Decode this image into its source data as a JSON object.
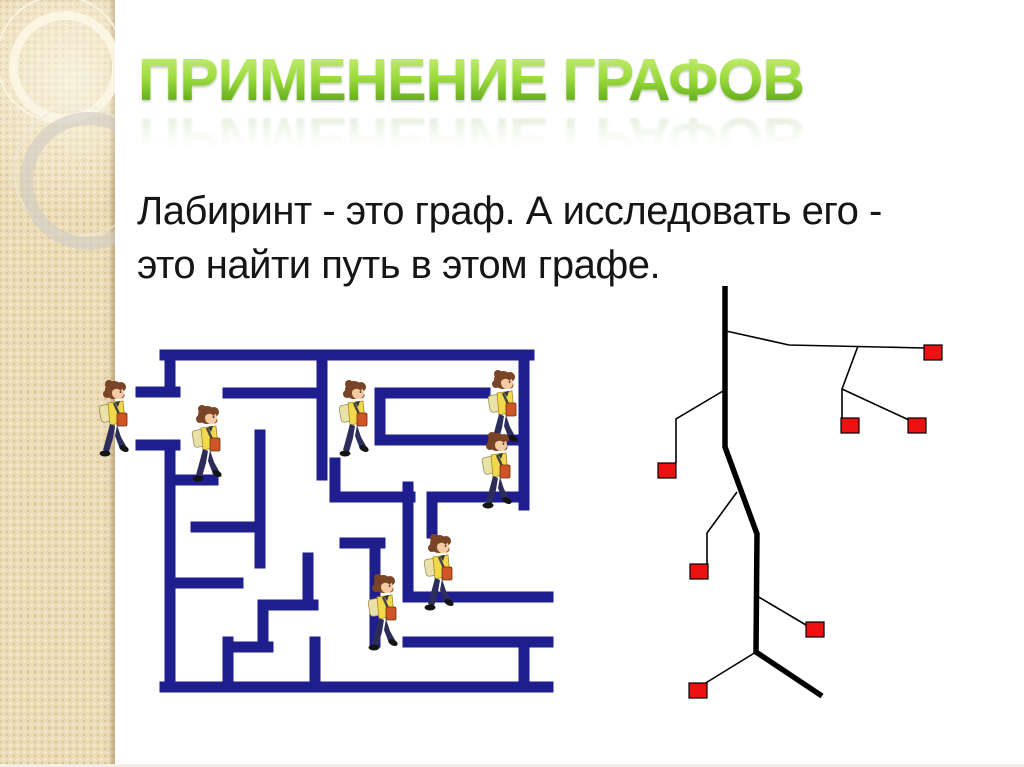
{
  "slide": {
    "title": "ПРИМЕНЕНИЕ ГРАФОВ",
    "body_line1": "Лабиринт - это граф. А исследовать его -",
    "body_line2": "это найти путь в этом графе."
  },
  "colors": {
    "title_gradient_top": "#cdf07e",
    "title_gradient_mid": "#9ddc3e",
    "title_gradient_bottom": "#4c9c0e",
    "maze_wall": "#1e1e8f",
    "tree_line": "#000000",
    "node_fill": "#ee1111",
    "sidebar_beige": "#ecdcb6",
    "slide_background": "#ffffff"
  },
  "maze": {
    "wall_thickness": 11,
    "segments": [
      [
        165,
        355,
        529,
        355
      ],
      [
        170,
        355,
        170,
        392
      ],
      [
        141,
        392,
        175,
        392
      ],
      [
        141,
        445,
        175,
        445
      ],
      [
        170,
        445,
        170,
        687
      ],
      [
        165,
        687,
        548,
        687
      ],
      [
        524,
        355,
        524,
        505
      ],
      [
        524,
        645,
        524,
        687
      ],
      [
        408,
        597,
        548,
        597
      ],
      [
        408,
        642,
        548,
        642
      ],
      [
        228,
        393,
        322,
        393
      ],
      [
        322,
        355,
        322,
        475
      ],
      [
        260,
        435,
        260,
        563
      ],
      [
        170,
        480,
        213,
        480
      ],
      [
        196,
        527,
        260,
        527
      ],
      [
        170,
        583,
        238,
        583
      ],
      [
        228,
        642,
        228,
        687
      ],
      [
        228,
        647,
        268,
        647
      ],
      [
        263,
        605,
        263,
        647
      ],
      [
        263,
        605,
        313,
        605
      ],
      [
        308,
        558,
        308,
        605
      ],
      [
        380,
        393,
        485,
        393
      ],
      [
        380,
        393,
        380,
        440
      ],
      [
        380,
        440,
        517,
        440
      ],
      [
        432,
        497,
        519,
        497
      ],
      [
        432,
        497,
        432,
        533
      ],
      [
        340,
        497,
        410,
        497
      ],
      [
        408,
        487,
        408,
        597
      ],
      [
        335,
        463,
        335,
        497
      ],
      [
        345,
        543,
        380,
        543
      ],
      [
        375,
        543,
        375,
        642
      ],
      [
        315,
        642,
        315,
        687
      ]
    ],
    "children_positions": [
      [
        95,
        380
      ],
      [
        188,
        405
      ],
      [
        335,
        380
      ],
      [
        484,
        370
      ],
      [
        478,
        432
      ],
      [
        420,
        534
      ],
      [
        364,
        574
      ]
    ]
  },
  "tree": {
    "trunk": [
      [
        725,
        286
      ],
      [
        725,
        447
      ],
      [
        757,
        534
      ],
      [
        756,
        652
      ],
      [
        822,
        696
      ]
    ],
    "trunk_width": 5.5,
    "edges": [
      [
        [
          726,
          331
        ],
        [
          789,
          345
        ],
        [
          924,
          348
        ]
      ],
      [
        [
          858,
          346
        ],
        [
          842,
          389
        ],
        [
          842,
          419
        ]
      ],
      [
        [
          842,
          389
        ],
        [
          909,
          420
        ]
      ],
      [
        [
          723,
          391
        ],
        [
          676,
          419
        ],
        [
          676,
          463
        ]
      ],
      [
        [
          737,
          492
        ],
        [
          707,
          533
        ],
        [
          707,
          564
        ]
      ],
      [
        [
          757,
          596
        ],
        [
          806,
          625
        ]
      ],
      [
        [
          756,
          652
        ],
        [
          704,
          684
        ]
      ]
    ],
    "edge_width": 1.6,
    "node_size": [
      18,
      15
    ],
    "nodes": [
      [
        924,
        345
      ],
      [
        841,
        418
      ],
      [
        908,
        418
      ],
      [
        658,
        463
      ],
      [
        690,
        564
      ],
      [
        806,
        622
      ],
      [
        689,
        683
      ]
    ]
  }
}
